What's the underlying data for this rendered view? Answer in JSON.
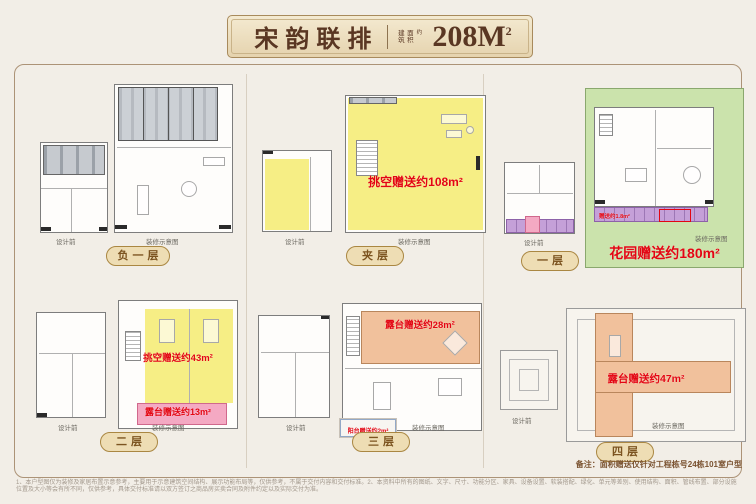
{
  "header": {
    "title": "宋韵联排",
    "area_prefix_col1": "建筑",
    "area_prefix_col2": "面积",
    "area_prefix_small": "约",
    "area_value": "208M",
    "area_sup": "2"
  },
  "captions": {
    "before": "设计前",
    "after": "装修示意图"
  },
  "floors": [
    {
      "name": "负一层"
    },
    {
      "name": "夹层",
      "a0": "挑空赠送约108m²"
    },
    {
      "name": "一层",
      "a0": "花园赠送约180m²",
      "a1": "赠送约1.8m²"
    },
    {
      "name": "二层",
      "a0": "挑空赠送约43m²",
      "a1": "露台赠送约13m²"
    },
    {
      "name": "三层",
      "a0": "露台赠送约28m²",
      "a1": "阳台赠送约2m²"
    },
    {
      "name": "四层",
      "a0": "露台赠送约47m²"
    }
  ],
  "note": "备注：面积赠送仅针对工程栋号24栋101室户型",
  "disclaimer": "1、本户型图仅为装修及家居布置示意参考，主要用于示意建筑空间结构、展示功能布局等，仅供参考，不属于交付内容和交付标准。2、本资料中所有的图纸、文字、尺寸、功能分区、家具、设备设置、软装搭配、绿化、单元等差别、使用结构、面积、管线布置、部分设施位置及大小等会有所不同，仅供参考，具体交付标准请以双方签订之商品房买卖合同及附件约定以及实际交付为准。"
}
